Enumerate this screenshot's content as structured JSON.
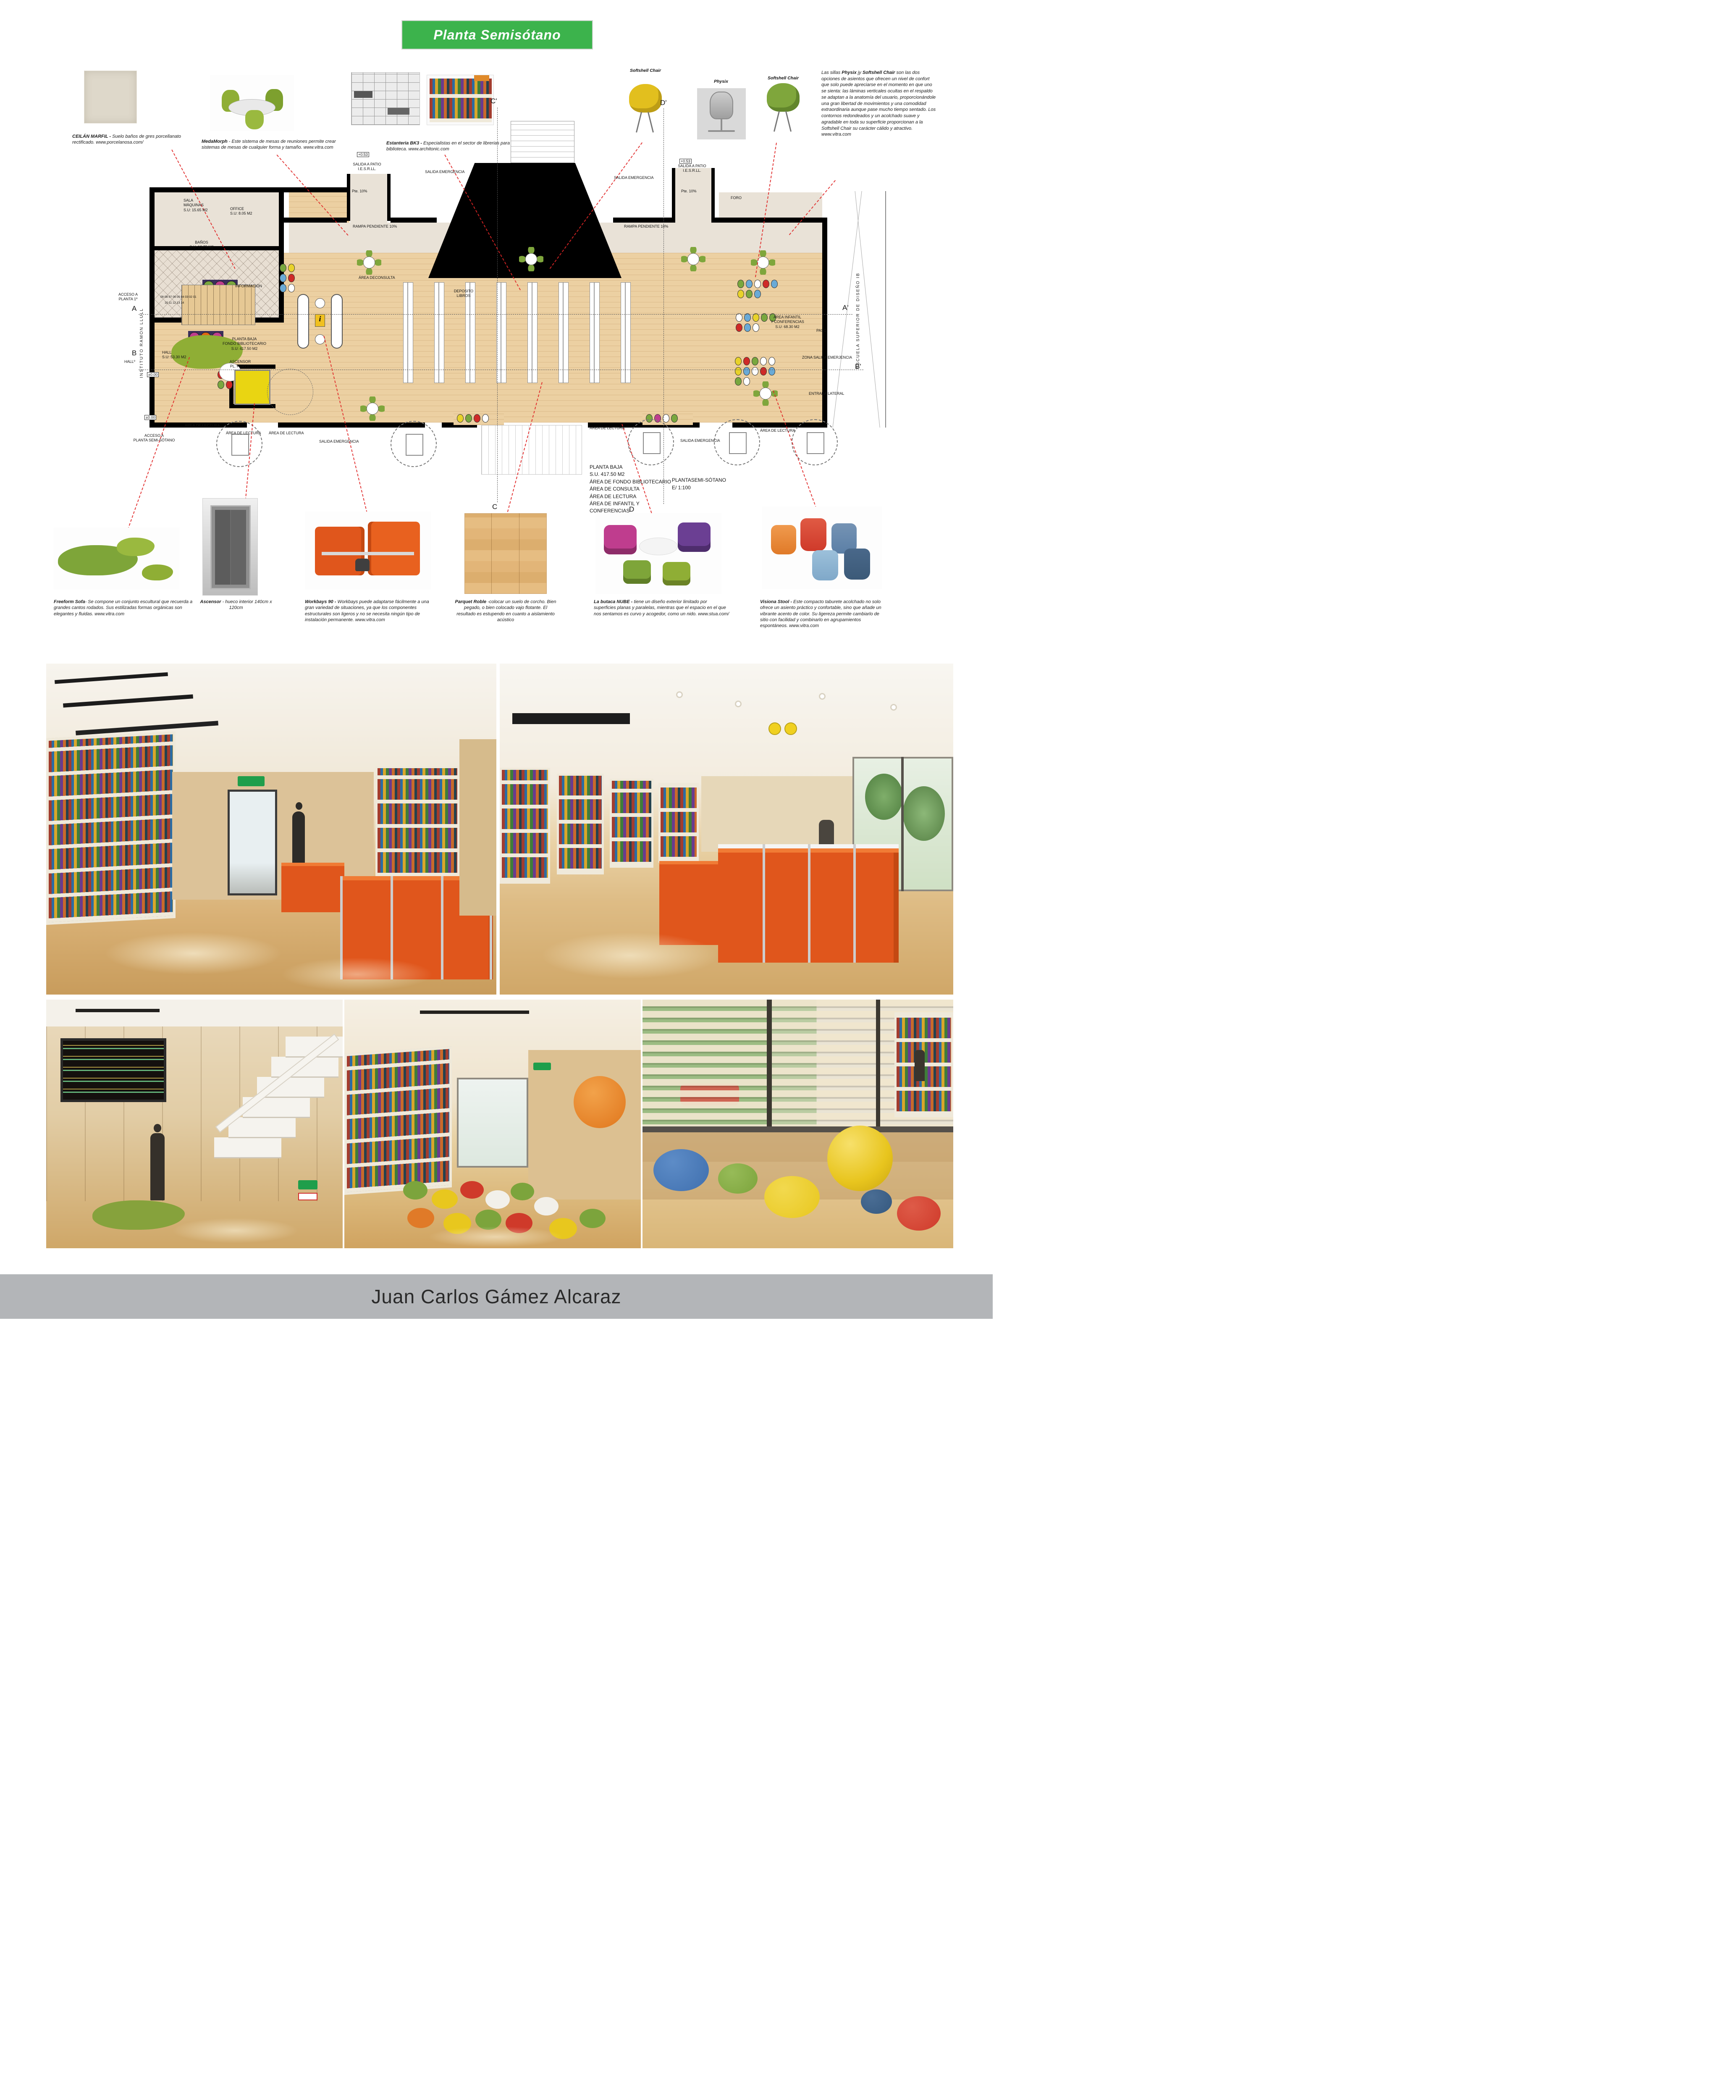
{
  "title": "Planta Semisótano",
  "footer": {
    "author": "Juan Carlos Gámez Alcaraz"
  },
  "colors": {
    "banner_green": "#3cb34c",
    "leader_red": "#e02626",
    "footer_gray": "#b3b5b8",
    "desk_orange": "#e0561c",
    "plan_wood": "#ecd0a2",
    "plan_beige": "#e9e2d7"
  },
  "products_top": {
    "ceilan": {
      "name": "CEILÁN MARFIL - ",
      "desc": "Suelo baños de gres porcellanato rectificado. www.porcelanosa.com/"
    },
    "medamorph": {
      "name": "MedaMorph",
      "desc": " - Este sistema de mesas de reuniones permite crear sistemas de mesas de cualquier forma y tamaño. www.vitra.com"
    },
    "bk3": {
      "name": "Estanteria BK3 - ",
      "desc": "Especialistas en el sector de librerias para biblioteca. www.architonic.com"
    }
  },
  "chairs": {
    "left_label": "Softshell Chair",
    "mid_label": "Physix",
    "right_label": "Softshell Chair",
    "para": {
      "p1": "Las sillas ",
      "b1": "Physix",
      "p2": " jy ",
      "b2": "Softshell Chair",
      "p3": " son las dos opciones de asientos que ofrecen un nivel de confort que solo puede apreciarse en el momento en que uno se sienta: las láminas verticales ocultas en el respaldo se adaptan a la anatomía del usuario, proporcionándole una gran libertad de movimientos y una comodidad extraordinaria aunque pase mucho tiempo sentado. Los contornos redondeados y un acolchado suave y agradable en toda su superficie proporcionan a la Softshell Chair su carácter cálido y atractivo. www.vitra.com"
    }
  },
  "plan": {
    "info_icon": "i",
    "labels": {
      "c_prime": "C'",
      "d_prime": "D'",
      "c": "C",
      "d": "D",
      "a": "A",
      "a_prime": "A'",
      "b": "B",
      "b_prime": "B'",
      "lv053": "+0.53",
      "lv000": "±0.00",
      "salida_patio": "SALIDA A PATIO\nI.E.S.R.LL.",
      "pte10": "Pte. 10%",
      "salida_emergencia": "SALIDA EMERGENCIA",
      "foro": "FORO",
      "rampa": "RAMPA PENDIENTE 10%",
      "sala_maquinas": "SALA\nMÁQUINAS\nS.U: 15.65 M2",
      "office": "OFFICE\nS.U: 8.05 M2",
      "banos": "BAÑOS\nS.U: 13.75 M2",
      "area_consulta": "ÁREA DECONSULTA",
      "informacion": "INFORMACIÓN",
      "deposito": "DEPOSITO\nLIBROS",
      "planta_fondo": "PLANTA BAJA\nFONDO BIBLIOTECARIO\nS.U: 417.50 M2",
      "ascensor": "ASCENSOR\nPL. PISO 1º",
      "hall": "HALL\nS.U: 53.30 M2",
      "hall_peq": "HALLº",
      "acceso_p1": "ACCESO A\nPLANTA 1º",
      "area_infantil": "ÁREA INFANTIL\nY CONFERENCIAS\nS.U: 68.30 M2",
      "paso": "PASO",
      "zona_salida": "ZONA SALIDA EMERJENCIA",
      "entrada_lateral": "ENTRADA LATERAL",
      "escuela": "ESCUELA SUPERIOR DE DISEÑO IB",
      "instituto": "INSTITUTO RAMON LLULL",
      "acceso_semi": "ACCESO A\nPLANTA SEMI-SÓTANO",
      "area_lectura": "ÁREA DE LECTURA",
      "stair_nums_1": "09 08 07 06 05 04 03 02 01",
      "stair_nums_2": "10 11 12 13 14"
    },
    "planta_baja_block": "PLANTA BAJA\nS.U. 417.50 M2\nÁREA DE FONDO BIBLIOTECARIO\nÁREA DE CONSULTA\nÁREA DE LECTURA\nÁREA DE INFANTIL Y\nCONFERENCIAS",
    "scale_block": "PLANTASEMI-SÓTANO\nE/ 1:100"
  },
  "products_bottom": {
    "freeform": {
      "name": "Freeform Sofa",
      "desc": "- Se compone un conjunto escultural que recuerda a grandes cantos rodados. Sus estilizadas formas orgánicas son elegantes y fluidas. www.vitra.com"
    },
    "ascensor": {
      "name": "Ascensor",
      "desc": " - hueco interior 140cm x 120cm"
    },
    "workbays": {
      "name": "Workbays 90 - ",
      "desc": "Workbays puede adaptarse fácilmente a una gran variedad de situaciones, ya que los componentes estructurales son ligeros y no se necesita ningún tipo de instalación permanente. www.vitra.com"
    },
    "parquet": {
      "name": "Parquet Roble",
      "desc": " -colocar un suelo de corcho. Bien pegado, o bien colocado vajo flotante. El resultado es estupendo en cuanto a aislamiento acústico"
    },
    "nube": {
      "name": "La butaca NUBE - ",
      "desc": "tiene un diseño exterior limitado por superficies planas y paralelas, mientras que el espacio en el que nos sentamos es curvo y acogedor, como un nido. www.stua.com/"
    },
    "visiona": {
      "name": "Visiona Stool - ",
      "desc": "Este compacto taburete acolchado no solo ofrece un asiento práctico y confortable, sino que añade un vibrante acento de color. Su ligereza permite cambiarlo de sitio con facilidad y combinarlo en agrupamientos espontáneos. www.vitra.com"
    }
  }
}
